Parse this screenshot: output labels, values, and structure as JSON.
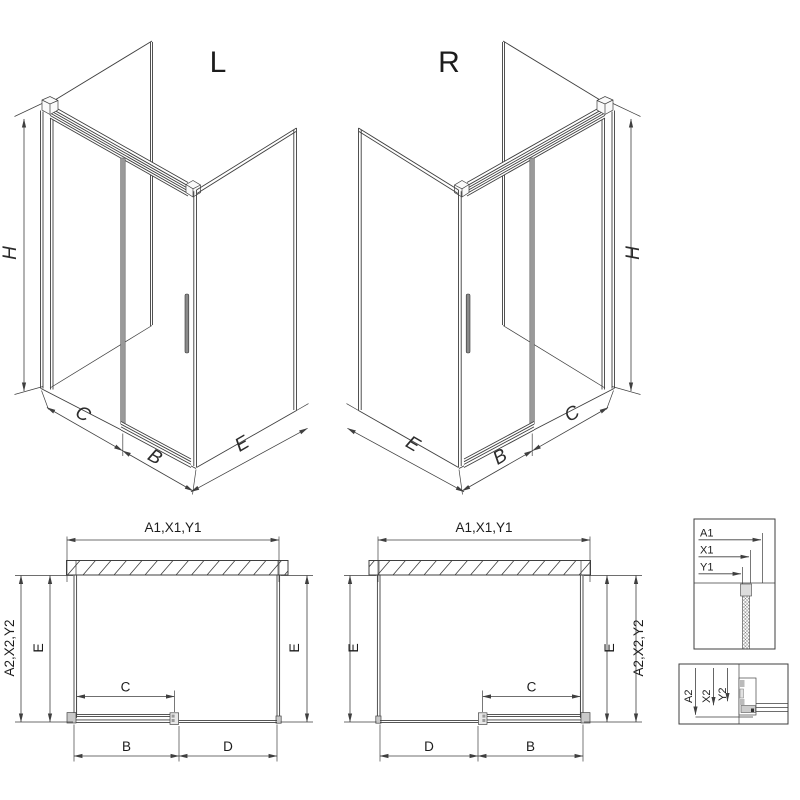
{
  "colors": {
    "line": "#3f3f3f",
    "panel_gray": "#c9c9c9",
    "door_stile": "#9a9a9a",
    "background": "#ffffff"
  },
  "iso_left": {
    "label": "L",
    "h": "H",
    "c": "C",
    "b": "B",
    "e": "E"
  },
  "iso_right": {
    "label": "R",
    "h": "H",
    "c": "C",
    "b": "B",
    "e": "E"
  },
  "plan_left": {
    "width_top": "A1,X1,Y1",
    "depth_outer": "A2,X2,Y2",
    "e": "E",
    "c": "C",
    "b": "B",
    "d": "D"
  },
  "plan_right": {
    "width_top": "A1,X1,Y1",
    "depth_outer": "A2,X2,Y2",
    "e": "E",
    "c": "C",
    "b": "B",
    "d": "D"
  },
  "detail_width": {
    "a1": "A1",
    "x1": "X1",
    "y1": "Y1"
  },
  "detail_depth": {
    "a2": "A2",
    "x2": "X2",
    "y2": "Y2"
  }
}
